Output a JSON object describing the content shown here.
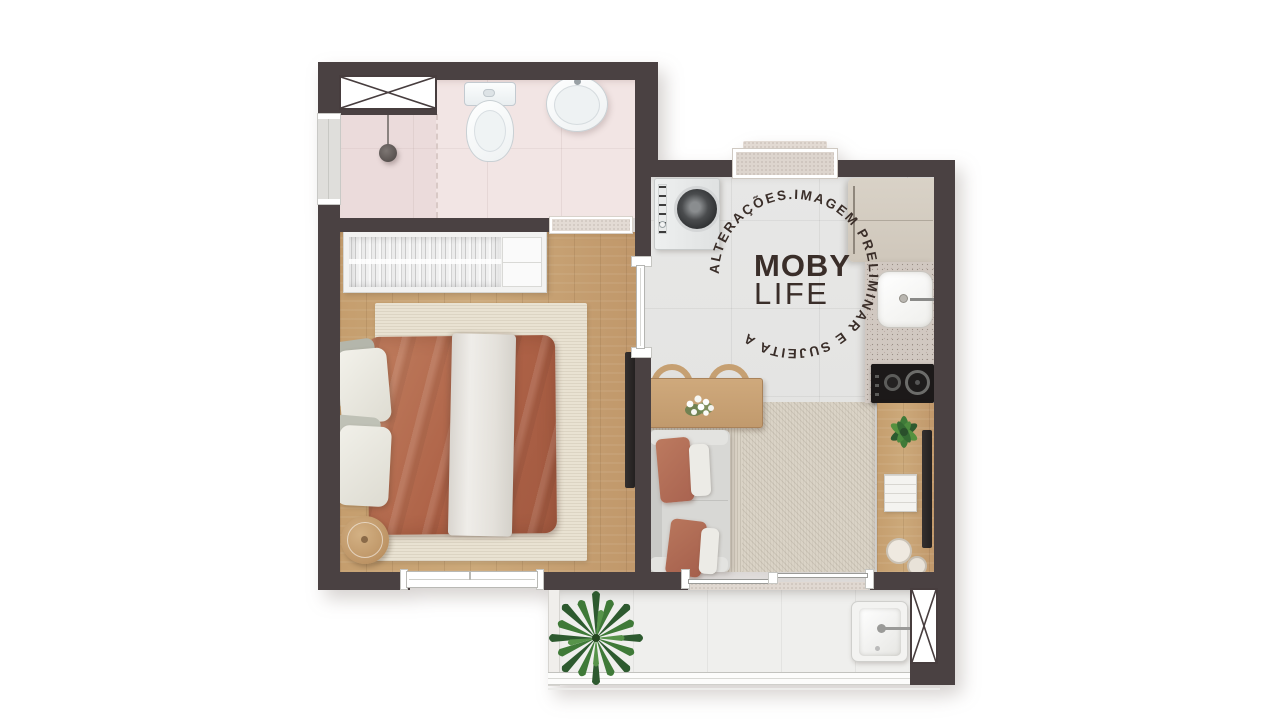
{
  "watermark": {
    "circular_text": "ALTERAÇÕES.IMAGEM PRELIMINAR E SUJEITA A ",
    "brand_top": "MOBY",
    "brand_bottom": "LIFE",
    "text_color": "#3a2e29"
  },
  "palette": {
    "wall": "#4a4142",
    "wood_floor": "#c59e6e",
    "bathroom_floor": "#f2e5e4",
    "kitchen_floor": "#e5e5e3",
    "balcony_floor": "#efefed",
    "bedroom_rug": "#e9e2d2",
    "living_rug": "#dad3c6",
    "duvet_terracotta": "#b06c50",
    "counter_granite": "#d1c8c1",
    "stove_black": "#1c1919",
    "fridge_beige": "#d5cec3",
    "plant_green": "#3f7a38"
  },
  "fixtures": [
    "ventilation-shaft",
    "shower",
    "toilet",
    "washbasin",
    "wardrobe",
    "double-bed",
    "bedside-table",
    "tv-panel",
    "washing-machine",
    "refrigerator",
    "kitchen-sink",
    "cooktop",
    "dining-table",
    "dining-chair",
    "sofa",
    "sideboard",
    "laundry-tank",
    "balcony-plant",
    "entry-door",
    "sliding-door",
    "window"
  ]
}
